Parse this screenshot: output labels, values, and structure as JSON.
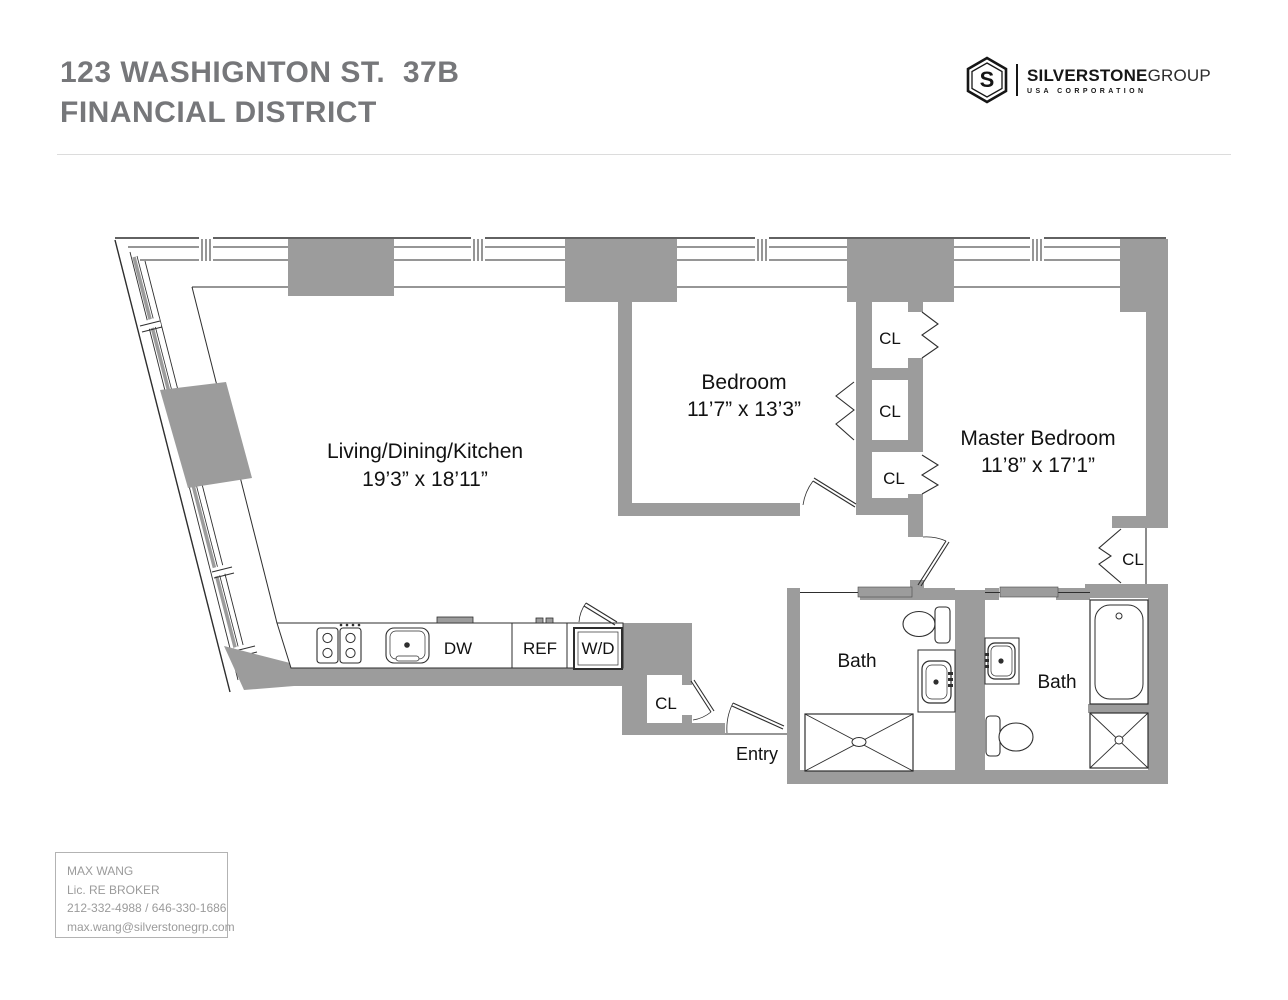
{
  "header": {
    "title_line1": "123 WASHIGNTON ST.  37B",
    "title_line2": "FINANCIAL DISTRICT"
  },
  "logo": {
    "monogram": "S",
    "brand_bold": "SILVERSTONE",
    "brand_light": "GROUP",
    "tagline": "USA CORPORATION"
  },
  "floorplan": {
    "rooms": {
      "living": {
        "name": "Living/Dining/Kitchen",
        "dims": "19’3” x 18’11”"
      },
      "bedroom": {
        "name": "Bedroom",
        "dims": "11’7” x 13’3”"
      },
      "master": {
        "name": "Master Bedroom",
        "dims": "11’8” x 17’1”"
      },
      "bath1": "Bath",
      "bath2": "Bath",
      "entry": "Entry"
    },
    "closets": [
      "CL",
      "CL",
      "CL",
      "CL",
      "CL"
    ],
    "appliances": {
      "dishwasher": "DW",
      "refrigerator": "REF",
      "washer_dryer": "W/D"
    }
  },
  "broker": {
    "name": "MAX WANG",
    "license": "Lic. RE BROKER",
    "phones": "212-332-4988 / 646-330-1686",
    "email": "max.wang@silverstonegrp.com"
  },
  "colors": {
    "wall_gray": "#9c9c9c",
    "plan_line": "#2e2e2e",
    "title_gray": "#76777a",
    "broker_text": "#9b9b9b",
    "logo_black": "#161616"
  }
}
